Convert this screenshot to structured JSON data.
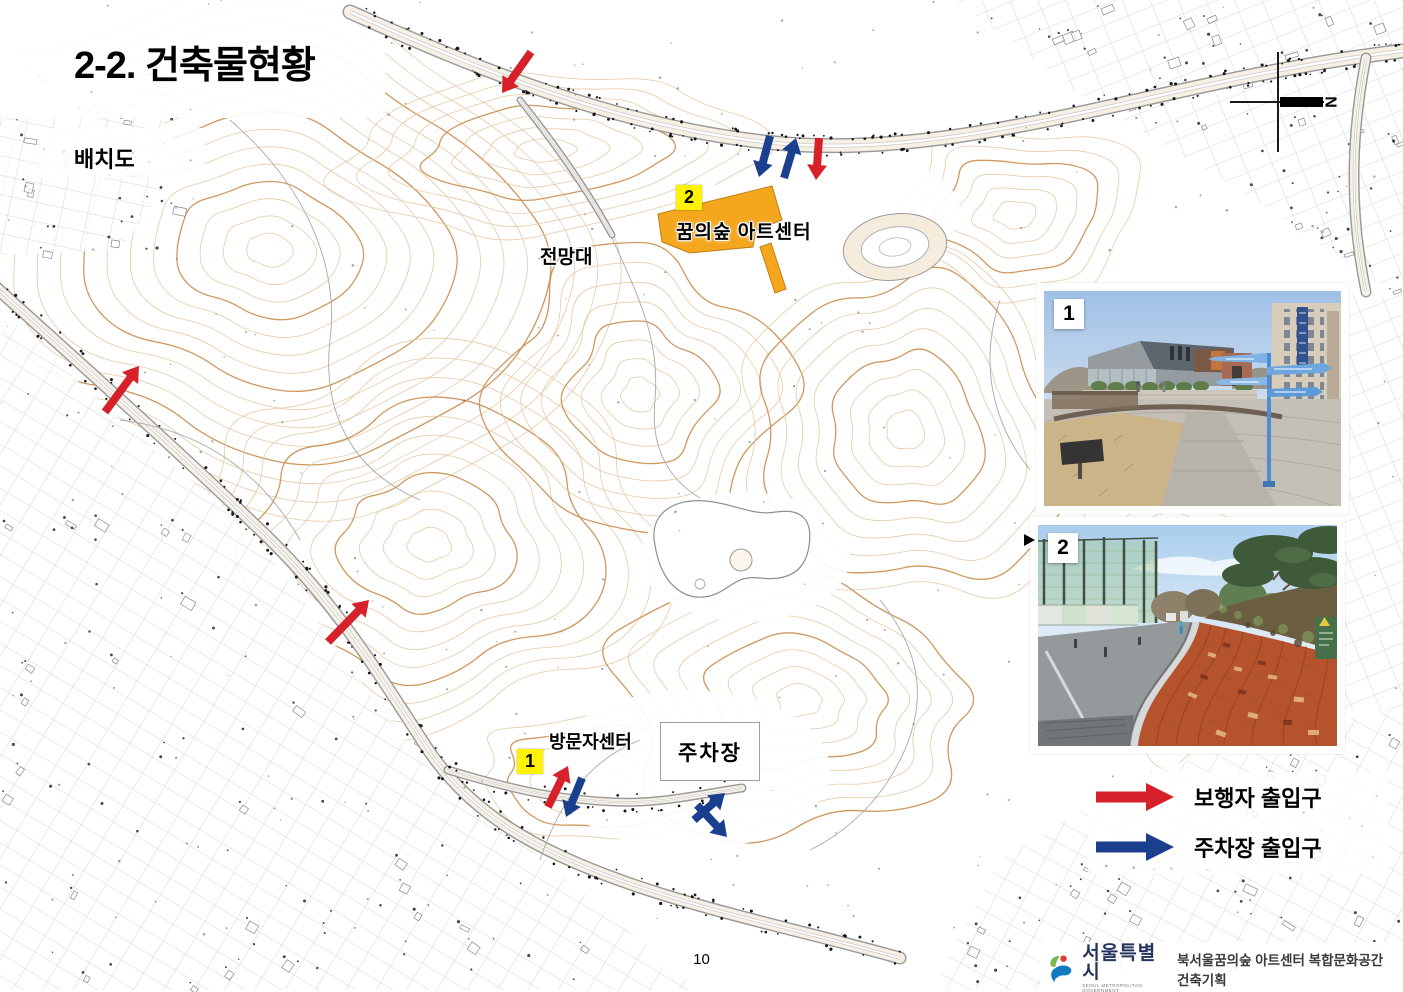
{
  "page": {
    "title": "2-2. 건축물현황",
    "subtitle": "배치도",
    "page_number": "10"
  },
  "map": {
    "labels": {
      "observatory": "전망대",
      "art_center": "꿈의숲 아트센터",
      "visitor_center": "방문자센터",
      "parking": "주차장"
    },
    "badges": {
      "art_center": "2",
      "visitor_center": "1"
    },
    "compass_letter": "N",
    "entrance_arrows": [
      {
        "type": "pedestrian",
        "x1": 531,
        "y1": 52,
        "x2": 502,
        "y2": 93
      },
      {
        "type": "parking",
        "x1": 770,
        "y1": 136,
        "x2": 759,
        "y2": 177
      },
      {
        "type": "parking",
        "x1": 784,
        "y1": 178,
        "x2": 796,
        "y2": 138
      },
      {
        "type": "pedestrian",
        "x1": 819,
        "y1": 138,
        "x2": 816,
        "y2": 180
      },
      {
        "type": "pedestrian",
        "x1": 105,
        "y1": 412,
        "x2": 139,
        "y2": 366
      },
      {
        "type": "pedestrian",
        "x1": 328,
        "y1": 642,
        "x2": 369,
        "y2": 600
      },
      {
        "type": "pedestrian",
        "x1": 548,
        "y1": 807,
        "x2": 568,
        "y2": 766
      },
      {
        "type": "parking",
        "x1": 582,
        "y1": 778,
        "x2": 566,
        "y2": 817
      },
      {
        "type": "parking",
        "x1": 694,
        "y1": 820,
        "x2": 725,
        "y2": 793
      },
      {
        "type": "parking",
        "x1": 697,
        "y1": 805,
        "x2": 727,
        "y2": 837
      }
    ]
  },
  "photos": [
    {
      "label": "1"
    },
    {
      "label": "2"
    }
  ],
  "legend": {
    "items": [
      {
        "label": "보행자 출입구",
        "color": "#D6202A"
      },
      {
        "label": "주차장 출입구",
        "color": "#1B3F8F"
      }
    ]
  },
  "footer": {
    "logo_text": "서울특별시",
    "logo_subtext": "SEOUL METROPOLITAN GOVERNMENT",
    "project": "북서울꿈의숲 아트센터 복합문화공간 건축기획"
  },
  "colors": {
    "arrow_red": "#D6202A",
    "arrow_blue": "#1B3F8F",
    "building_orange": "#F4A61D",
    "badge_yellow": "#FFF200",
    "contour_light": "#E6C7A0",
    "contour_dark": "#CB9257"
  }
}
